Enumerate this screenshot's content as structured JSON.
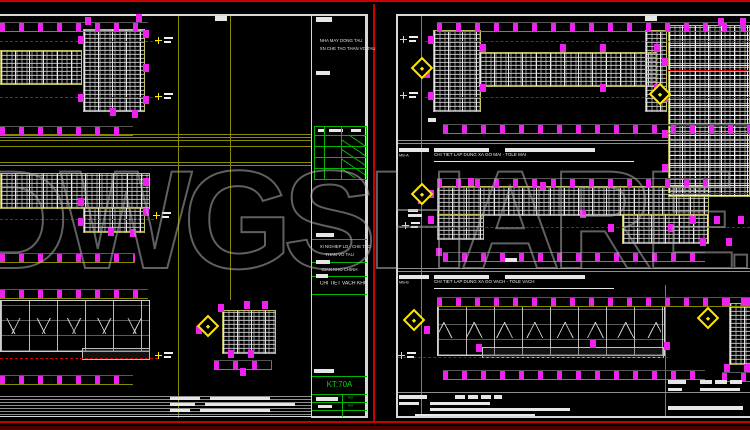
{
  "watermark": {
    "main": "DWGSHARE",
    "suffix": ".com"
  },
  "colors": {
    "background": "#000000",
    "border_red": "#c80000",
    "marker_magenta": "#ee22ee",
    "construction_yellow": "#8a8a00",
    "table_green": "#00b400",
    "hatch_gray": "#c8c8c8",
    "watermark_gray": "#aaaaaa"
  },
  "icons": {
    "section_marker": "yellow-diamond",
    "datum": "cross-with-tag"
  },
  "left_sheet": {
    "title_block": {
      "header_line1": "NHA MAY DONG TAU",
      "header_line2": "XN CHE TAO THAN VO TAU",
      "company_line1": "XI NGHIEP LD - CHE TAO",
      "company_line2": "THAN VO TAU",
      "project": "GIAN KHO CHINH",
      "drawing_title": "CHI TIET VACH KHO",
      "drawing_no": "KT:70A",
      "sheet_size": "A3"
    }
  },
  "right_sheet": {
    "title1": {
      "label": "MB-A",
      "text": "CHI TIET LAP DUNG XA GO MAI - TOLE MAI"
    },
    "title2": {
      "label": "MB-B",
      "text": "CHI TIET LAP DUNG XA GO VACH - TOLE VACH"
    }
  }
}
